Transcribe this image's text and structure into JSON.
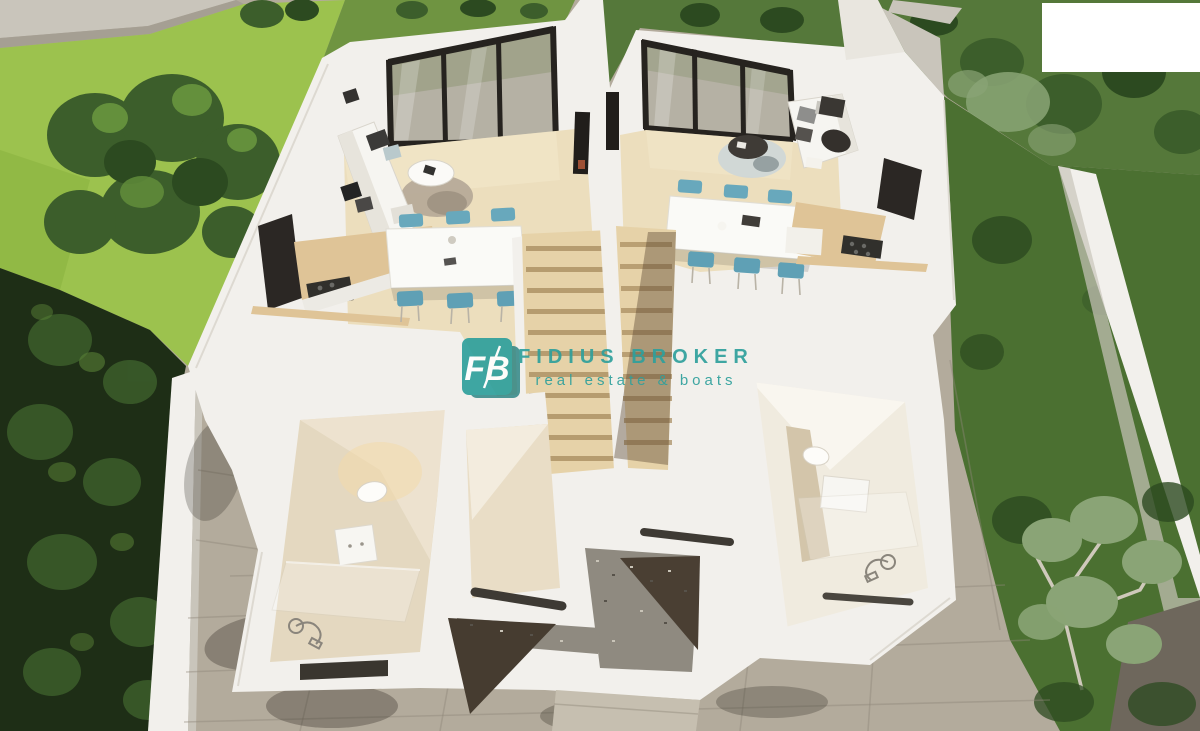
{
  "watermark": {
    "logo_text": "FB",
    "title": "FIDIUS BROKER",
    "subtitle": "real estate & boats"
  },
  "overlay": {
    "top_right_patch_color": "#ffffff"
  },
  "colors": {
    "teal": "#2fa09c",
    "tealDark": "#1f7d7c",
    "wallWhite": "#f2f0ec",
    "wallShade": "#dbd7ce",
    "wallDark": "#c9c5bb",
    "lawn": "#9cc24e",
    "tree": "#3c5e2b",
    "treeDark": "#2c4a20",
    "treeLight": "#64903c",
    "foliage": "#1e2e16",
    "grassRight": "#4b7031",
    "sage": "#8aa476",
    "terrace": "#b3ab9c",
    "terraceLight": "#c6bfb0",
    "seam": "#8f8779",
    "stone": "#8f8a80",
    "shadowBrown": "#4a3f33",
    "woodFloor": "#ecdebd",
    "woodCounter": "#dfc497",
    "woodStair": "#e6d2a8",
    "stairShadow": "#a68a5d",
    "glass": "#b5b1a4",
    "glassFrame": "#26231f",
    "chairBlue": "#68a8bc",
    "chairBlueDeep": "#5fa0b5",
    "bathFloor": "#e4d8c0",
    "darkCabinet": "#2b2724"
  }
}
